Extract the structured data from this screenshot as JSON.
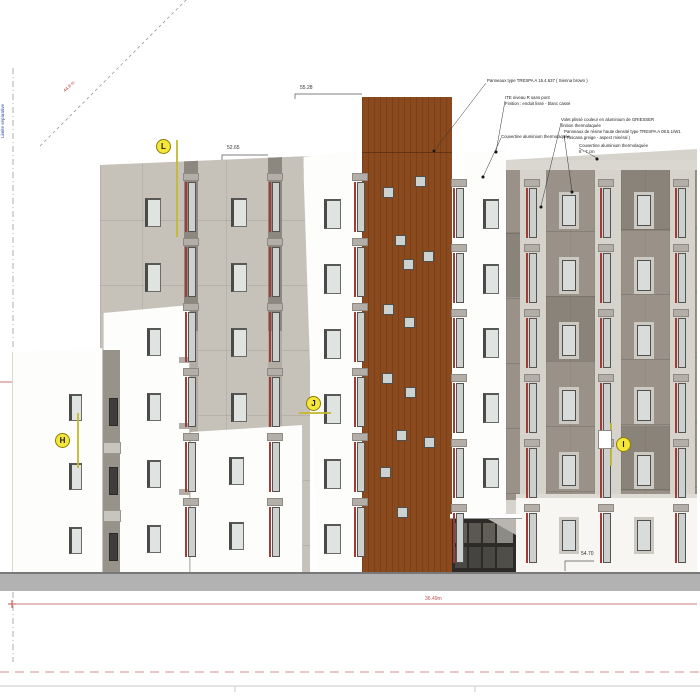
{
  "drawing": {
    "annotations": [
      {
        "x": 487,
        "y": 78,
        "lines": [
          "Panneaux type TRESPA A 15.4.637 ( Sienna brown )"
        ]
      },
      {
        "x": 505,
        "y": 95,
        "lines": [
          "ITE niveau R sans pont",
          "Finition : enduit lissé - blanc cassé"
        ]
      },
      {
        "x": 501,
        "y": 134,
        "lines": [
          "Couvertine aluminium thermolaquée"
        ]
      },
      {
        "x": 561,
        "y": 117,
        "lines": [
          "Volet plissé couleur en aluminium de GRIESSER",
          "finition thermolaquée"
        ]
      },
      {
        "x": 564,
        "y": 129,
        "lines": [
          "Panneaux de résine haute densité type TRESPA A 08.5.1/W1",
          "( Toscana greige - aspect minéral )"
        ]
      },
      {
        "x": 579,
        "y": 143,
        "lines": [
          "Couvertine aluminium thermolaquée",
          "6 - 7 cm"
        ]
      }
    ],
    "dimensions": [
      {
        "text": "55.28",
        "x": 300,
        "y": 85
      },
      {
        "text": "52.65",
        "x": 227,
        "y": 145
      },
      {
        "text": "54.70",
        "x": 581,
        "y": 551
      },
      {
        "text": "36.49m",
        "x": 425,
        "y": 596,
        "red": true
      }
    ],
    "markers": [
      {
        "id": "L",
        "cx": 163,
        "cy": 146,
        "line": [
          177,
          140,
          177,
          237
        ]
      },
      {
        "id": "H",
        "cx": 62,
        "cy": 440,
        "line": [
          78,
          413,
          78,
          468
        ]
      },
      {
        "id": "J",
        "cx": 313,
        "cy": 403,
        "line": [
          299,
          413,
          331,
          413
        ]
      },
      {
        "id": "I",
        "cx": 623,
        "cy": 444,
        "line": [
          611,
          423,
          611,
          466
        ],
        "patch": [
          598,
          430,
          14,
          19
        ]
      }
    ],
    "side_texts": {
      "boundary": "Limite séparative",
      "slope": "44.8 m"
    },
    "colors": {
      "brown": "#8a4a1d",
      "greige": "#c6c1b9",
      "taupe": "#9a9288",
      "light_band": "#d6d3cd",
      "red_accent": "#a03b36",
      "marker_yellow": "#f5e73a",
      "dim_red": "#c0504d",
      "ground": "#b2b2b2"
    },
    "facade": {
      "std_windows": [
        {
          "x": 69,
          "w": 13,
          "h": 27,
          "style": "dark",
          "rows": [
            394,
            463,
            527
          ]
        },
        {
          "x": 147,
          "w": 14,
          "h": 28,
          "style": "dark",
          "rows": [
            328,
            393,
            460,
            525
          ]
        },
        {
          "x": 229,
          "w": 15,
          "h": 28,
          "style": "dark",
          "rows": [
            457,
            522
          ]
        },
        {
          "x": 145,
          "w": 16,
          "h": 29,
          "style": "dark",
          "rows": [
            198,
            263
          ]
        },
        {
          "x": 231,
          "w": 16,
          "h": 29,
          "style": "dark",
          "rows": [
            198,
            263,
            328,
            393
          ]
        },
        {
          "x": 324,
          "w": 17,
          "h": 30,
          "style": "dark",
          "rows": [
            199,
            264,
            329,
            394,
            459,
            524
          ]
        },
        {
          "x": 483,
          "w": 16,
          "h": 30,
          "style": "dark",
          "rows": [
            199,
            264,
            328,
            393,
            458
          ]
        },
        {
          "x": 562,
          "w": 14,
          "h": 31,
          "style": "light",
          "rows": [
            195,
            260,
            325,
            390,
            455,
            520
          ]
        },
        {
          "x": 637,
          "w": 14,
          "h": 31,
          "style": "light",
          "rows": [
            195,
            260,
            325,
            390,
            455,
            520
          ]
        }
      ],
      "tall_windows": [
        {
          "x": 188,
          "rows": [
            182,
            247,
            312,
            377,
            442,
            507
          ]
        },
        {
          "x": 272,
          "rows": [
            182,
            247,
            312,
            377,
            442,
            507
          ]
        },
        {
          "x": 357,
          "rows": [
            182,
            247,
            312,
            377,
            442,
            507
          ]
        },
        {
          "x": 456,
          "rows": [
            188,
            253,
            318,
            383,
            448,
            513
          ]
        },
        {
          "x": 529,
          "rows": [
            188,
            253,
            318,
            383,
            448,
            513
          ]
        },
        {
          "x": 603,
          "rows": [
            188,
            253,
            318,
            383,
            448,
            513
          ]
        },
        {
          "x": 678,
          "rows": [
            188,
            253,
            318,
            383,
            448,
            513
          ]
        }
      ],
      "brown_squares": [
        [
          415,
          176
        ],
        [
          383,
          187
        ],
        [
          395,
          235
        ],
        [
          423,
          251
        ],
        [
          403,
          259
        ],
        [
          383,
          304
        ],
        [
          404,
          317
        ],
        [
          382,
          373
        ],
        [
          405,
          387
        ],
        [
          396,
          430
        ],
        [
          424,
          437
        ],
        [
          380,
          467
        ],
        [
          397,
          507
        ]
      ]
    }
  }
}
